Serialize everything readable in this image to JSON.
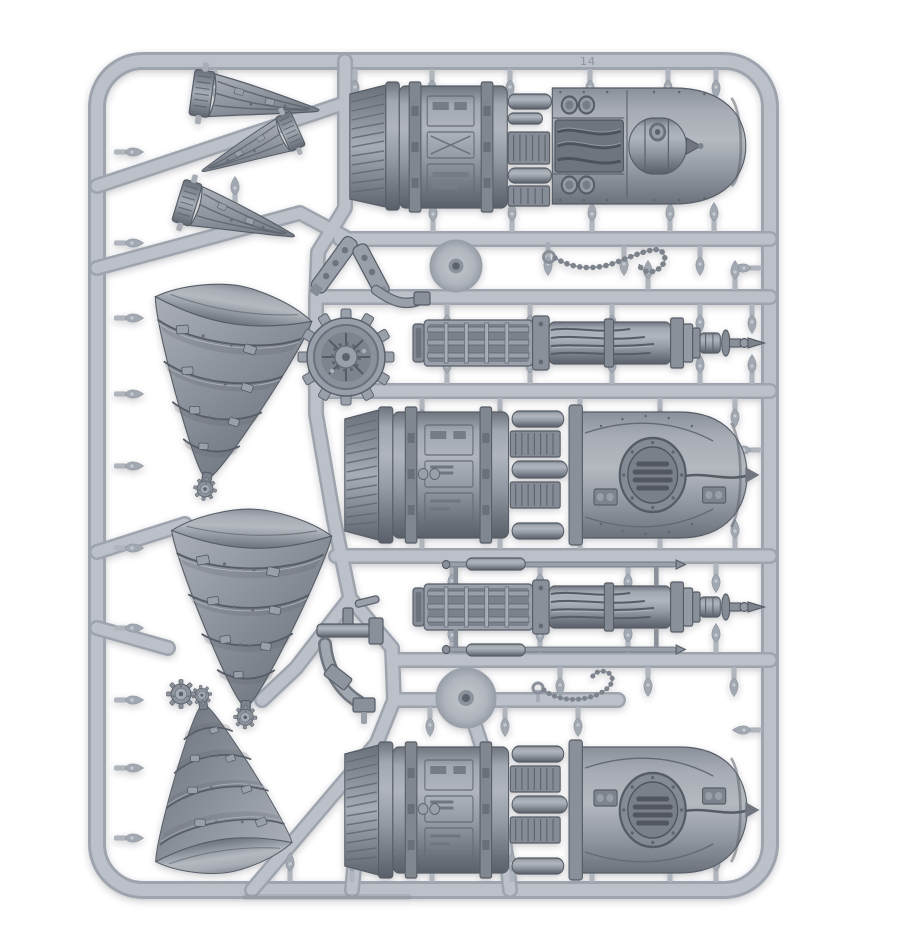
{
  "meta": {
    "type": "product-photo",
    "subject": "Grey plastic model-kit sprue with drill cones, engine housings, lance barrels, chains and gears",
    "background_color": "#ffffff"
  },
  "sprue": {
    "frame_number": "14",
    "plastic_light": "#bcc1c9",
    "plastic_mid": "#8f959e",
    "plastic_dark": "#5a606a"
  },
  "parts": {
    "small_drill_cones": 3,
    "large_drill_cones": 3,
    "engine_housings": 3,
    "lance_barrels": 2,
    "chains": 2,
    "cog_wheel": 1,
    "junction_discs": 2,
    "small_gears": 4,
    "bracket_pieces": 2,
    "pipe_pieces": 2
  }
}
